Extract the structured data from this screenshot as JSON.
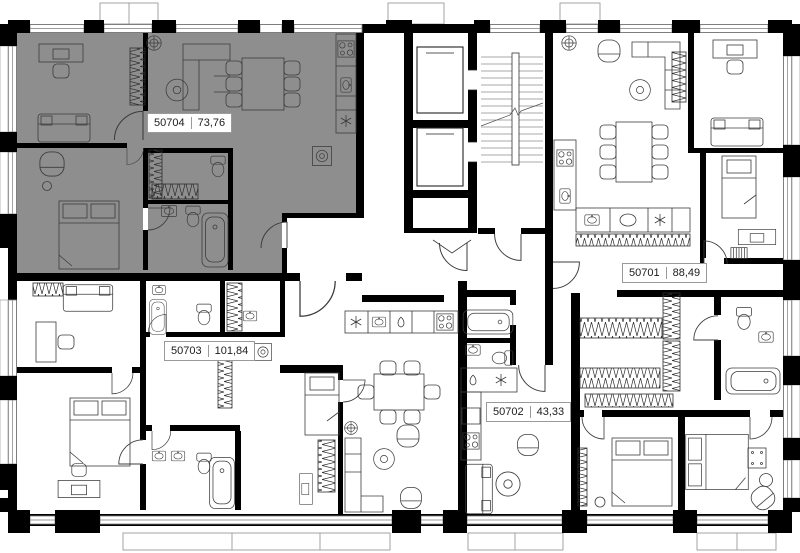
{
  "units": [
    {
      "id": "50701",
      "area": "88,49"
    },
    {
      "id": "50702",
      "area": "43,33"
    },
    {
      "id": "50703",
      "area": "101,84"
    },
    {
      "id": "50704",
      "area": "73,76"
    }
  ],
  "highlighted_unit_id": "50704",
  "colors": {
    "background": "#ffffff",
    "wall": "#000000",
    "highlight": "#8E8E8E"
  }
}
